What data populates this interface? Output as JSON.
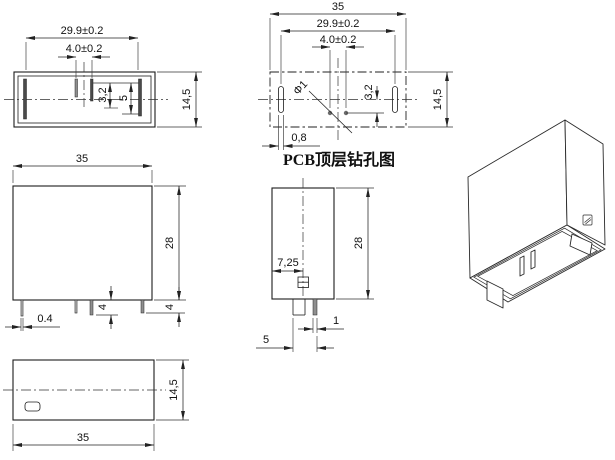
{
  "page": {
    "background": "#ffffff",
    "line_color": "#1c1c1c"
  },
  "views": {
    "bottom": {
      "label": "relay bottom view",
      "dims": {
        "pin_span": "29.9±0.2",
        "inner_pin_span": "4.0±0.2",
        "pin_offset": "3,2",
        "pin_length": "5",
        "depth": "14,5"
      }
    },
    "pcb": {
      "title": "PCB顶层钻孔图",
      "dims": {
        "body_width": "35",
        "pin_span": "29.9±0.2",
        "inner_pin_span": "4.0±0.2",
        "hole_diameter": "Φ1",
        "hole_offset": "3,2",
        "slot_width": "0,8",
        "depth": "14,5"
      }
    },
    "front": {
      "dims": {
        "width": "35",
        "height": "28",
        "pin_thickness": "0.4",
        "pin_length_mid": "4",
        "pin_length_right": "4"
      }
    },
    "side": {
      "dims": {
        "center_offset": "7,25",
        "height": "28",
        "tab_thickness": "1",
        "pin_span": "5"
      }
    },
    "top": {
      "dims": {
        "width": "35",
        "depth": "14,5"
      }
    }
  }
}
